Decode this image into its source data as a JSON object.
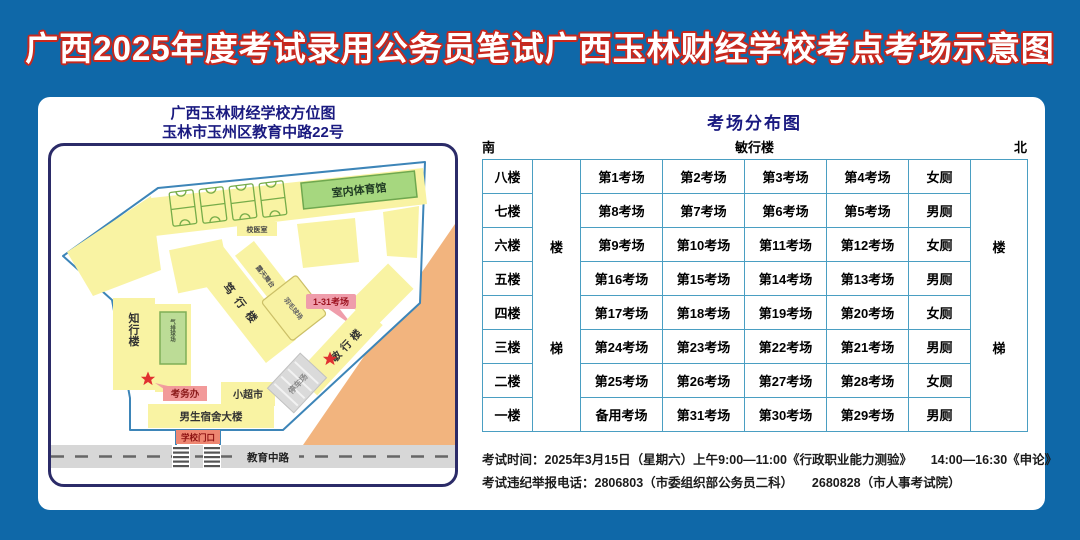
{
  "title": "广西2025年度考试录用公务员笔试广西玉林财经学校考点考场示意图",
  "colors": {
    "page_background": "#0F68A8",
    "title_outline_red": "#C8281E",
    "heading_navy": "#1A1A80",
    "building_yellow": "#F9F3A3",
    "gym_green": "#A6D77F",
    "court_green": "#BCDC96",
    "outside_orange": "#F2B47E",
    "label_pink": "#F29A9A",
    "table_border_blue": "#4A9EC2",
    "road_gray": "#D7D7D7",
    "star_red": "#E03030"
  },
  "map": {
    "title_line1": "广西玉林财经学校方位图",
    "title_line2": "玉林市玉州区教育中路22号",
    "labels": {
      "gym": "室内体育馆",
      "clinic": "校医室",
      "duxing_building": "笃行楼",
      "stage": "露天舞台",
      "badminton": "羽毛球场",
      "exam_rooms_callout": "1-31考场",
      "minxing_building": "敏行楼",
      "zhixing_building": "知行楼",
      "volleyball": "气排球场",
      "exam_office": "考务办",
      "supermarket": "小超市",
      "dorm": "男生宿舍大楼",
      "parking": "停车场",
      "gate": "学校门口",
      "road": "教育中路"
    }
  },
  "distribution": {
    "title": "考场分布图",
    "south": "南",
    "building": "敏行楼",
    "north": "北",
    "stair_top": "楼",
    "stair_bottom": "梯",
    "rows": [
      {
        "floor": "八楼",
        "rooms": [
          "第1考场",
          "第2考场",
          "第3考场",
          "第4考场"
        ],
        "toilet": "女厕"
      },
      {
        "floor": "七楼",
        "rooms": [
          "第8考场",
          "第7考场",
          "第6考场",
          "第5考场"
        ],
        "toilet": "男厕"
      },
      {
        "floor": "六楼",
        "rooms": [
          "第9考场",
          "第10考场",
          "第11考场",
          "第12考场"
        ],
        "toilet": "女厕"
      },
      {
        "floor": "五楼",
        "rooms": [
          "第16考场",
          "第15考场",
          "第14考场",
          "第13考场"
        ],
        "toilet": "男厕"
      },
      {
        "floor": "四楼",
        "rooms": [
          "第17考场",
          "第18考场",
          "第19考场",
          "第20考场"
        ],
        "toilet": "女厕"
      },
      {
        "floor": "三楼",
        "rooms": [
          "第24考场",
          "第23考场",
          "第22考场",
          "第21考场"
        ],
        "toilet": "男厕"
      },
      {
        "floor": "二楼",
        "rooms": [
          "第25考场",
          "第26考场",
          "第27考场",
          "第28考场"
        ],
        "toilet": "女厕"
      },
      {
        "floor": "一楼",
        "rooms": [
          "备用考场",
          "第31考场",
          "第30考场",
          "第29考场"
        ],
        "toilet": "男厕"
      }
    ]
  },
  "footer": {
    "line1": "考试时间：2025年3月15日（星期六）上午9:00—11:00《行政职业能力测验》　　14:00—16:30《申论》",
    "line2": "考试违纪举报电话：2806803（市委组织部公务员二科）　　2680828（市人事考试院）"
  }
}
